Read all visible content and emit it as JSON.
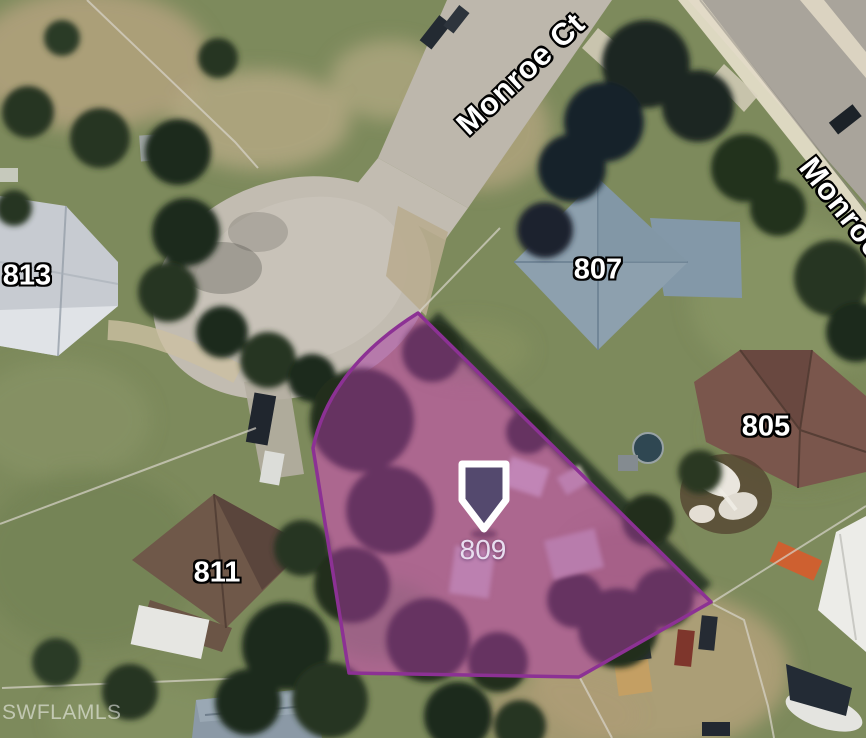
{
  "map": {
    "streets": [
      {
        "name": "Monroe Ct"
      },
      {
        "name": "Monroe"
      }
    ],
    "addresses": [
      {
        "number": "813"
      },
      {
        "number": "807"
      },
      {
        "number": "805"
      },
      {
        "number": "811"
      }
    ],
    "selected_parcel": {
      "address_number": "809",
      "outline_color": "#8C3194",
      "fill_color": "rgba(170,55,165,0.5)",
      "marker": {
        "icon": "location-pin-icon",
        "fill": "#54496E",
        "border": "#FFFFFF"
      }
    },
    "watermark": "SWFLAMLS"
  }
}
